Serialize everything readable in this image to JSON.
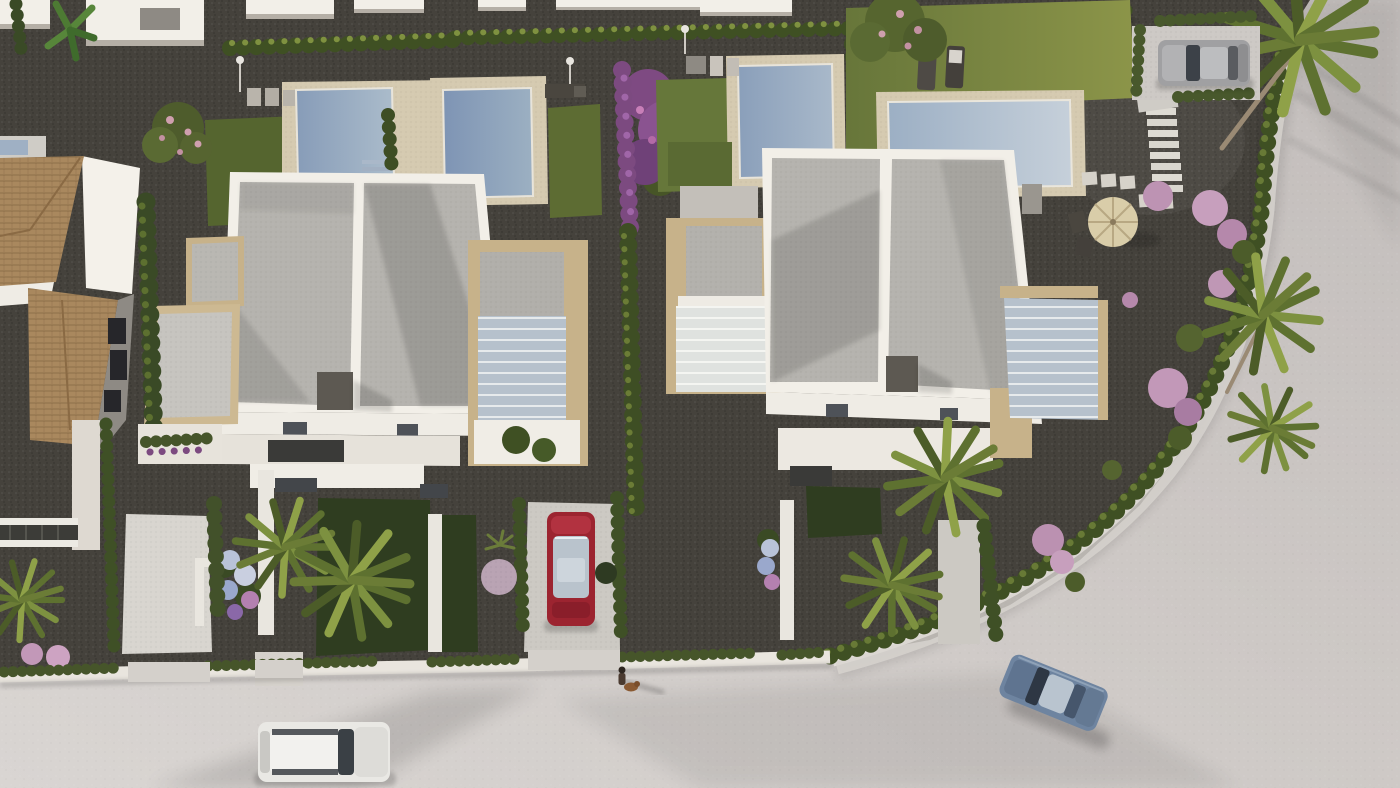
{
  "scene": {
    "type": "3d-aerial-architectural-render",
    "description": "Bird's-eye render of a residential development: two modern white flat-roof villas with private pools and gravel gardens, a traditional terracotta tiled-roof house on the left, palm trees, purple flowering shrubs, and a light curving street with parked cars and a pedestrian walking a dog",
    "lighting": "low warm sun, long soft shadows toward lower-right"
  },
  "palette": {
    "road": "#cdc8c5",
    "road_light": "#d9d5d2",
    "road_dark": "#c2bdbb",
    "sidewalk": "#d7d3cf",
    "curb_white": "#e3dfda",
    "gravel": "#45423c",
    "lawn": "#67763a",
    "lawn_lit": "#8c9549",
    "grass_mid": "#5d6c33",
    "grass_front": "#2f3d20",
    "hedge": "#3f5023",
    "hedge_lit": "#7f9140",
    "cypress": "#3a4a26",
    "pool_deck": "#d5cab0",
    "villa_white": "#f2efe8",
    "villa_front": "#efece5",
    "wall_shadow": "#b5afa6",
    "roof_gray": "#b5b3ae",
    "travertine": "#c7b28a",
    "terracotta": "#a9885e",
    "terracotta_line": "#8a6a44",
    "purple_bloom": "#7c4a80",
    "pink_bush": "#bd93b3",
    "blossom_pink": "#cf9fae",
    "parasol": "#d9cda9",
    "chair_dark": "#4a463f",
    "car_red": "#9c2430",
    "car_blue": "#6e84a0",
    "car_white": "#e9e8e4",
    "car_silver": "#a0a0a2",
    "window_dark": "#4e5258",
    "chimney": "#5d5952",
    "palm_trunk": "#9a8a74",
    "person_dark": "#4a3a30",
    "dog_brown": "#8a5a33",
    "pool1_a": "#879cb8",
    "pool1_b": "#abbccb",
    "pool2_a": "#7e94b4",
    "pool2_b": "#9cb0c2",
    "pool3_a": "#8a9fba",
    "pool3_b": "#a9b9ca",
    "pool4_a": "#9cafc4",
    "pool4_b": "#c6d0da"
  },
  "objects": {
    "villas": [
      {
        "id": "villa-a",
        "style": "modern white villa, two-panel flat gray roof, travertine pergolas, glass canopy annex"
      },
      {
        "id": "villa-b",
        "style": "modern white villa, mirrored twin of villa A, glass canopy annexes both sides"
      },
      {
        "id": "tiled-roof-house",
        "style": "traditional house with terracotta hip roofs and white walls"
      }
    ],
    "pools": [
      {
        "id": "pool-1",
        "plot": "top-left"
      },
      {
        "id": "pool-2",
        "plot": "top-center-left"
      },
      {
        "id": "pool-3",
        "plot": "top-center-right"
      },
      {
        "id": "pool-4",
        "plot": "top-right with large lawn and sun loungers"
      }
    ],
    "vehicles": [
      {
        "id": "silver-suv",
        "location": "top-right hedge parking bay"
      },
      {
        "id": "red-car",
        "location": "center driveway between villas"
      },
      {
        "id": "blue-car",
        "location": "street, bottom-right curve"
      },
      {
        "id": "white-car",
        "location": "street, bottom-left"
      }
    ],
    "people": [
      {
        "id": "pedestrian-with-dog",
        "location": "sidewalk below center driveway"
      }
    ],
    "garden_features": [
      "parasol-with-bistro-chairs",
      "sun-loungers",
      "outdoor-showers",
      "stepping-stone-path",
      "garden-stairs",
      "palm-trees",
      "purple-bougainvillea",
      "pink-shrub-balls",
      "cypress-hedges",
      "hydrangea-beds"
    ]
  }
}
